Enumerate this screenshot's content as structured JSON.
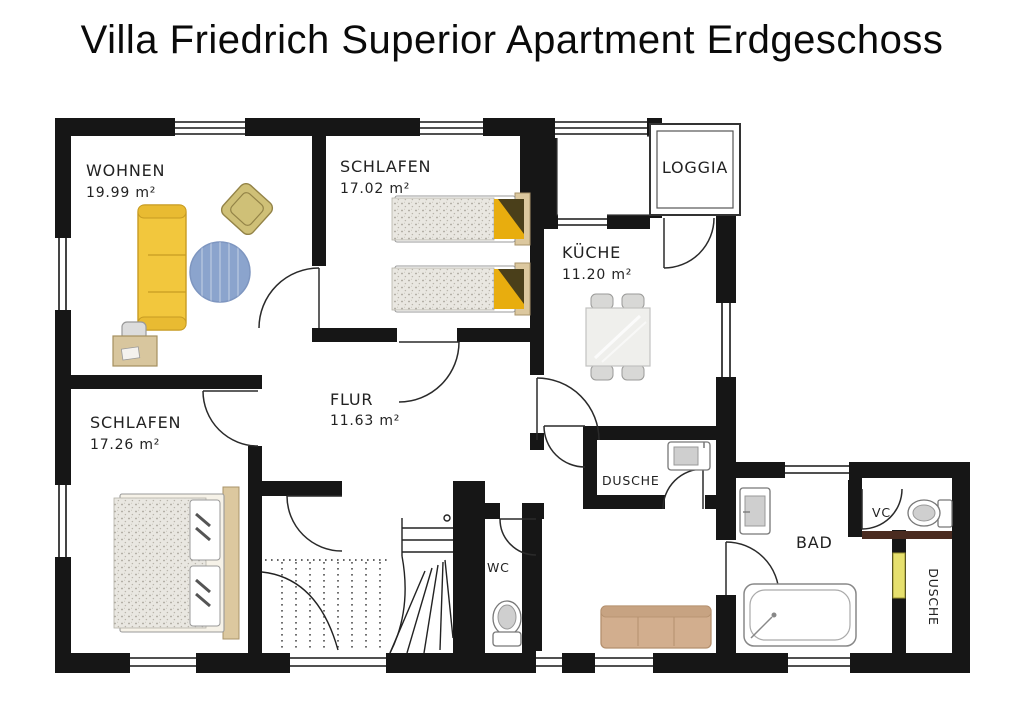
{
  "title": "Villa Friedrich Superior Apartment Erdgeschoss",
  "plan": {
    "rooms": {
      "wohnen": {
        "name": "WOHNEN",
        "area": "19.99 m²"
      },
      "schlafen_top": {
        "name": "SCHLAFEN",
        "area": "17.02 m²"
      },
      "kueche": {
        "name": "KÜCHE",
        "area": "11.20 m²"
      },
      "loggia": {
        "name": "LOGGIA"
      },
      "flur": {
        "name": "FLUR",
        "area": "11.63 m²"
      },
      "schlafen_bottom": {
        "name": "SCHLAFEN",
        "area": "17.26 m²"
      },
      "dusche_mid": {
        "name": "DUSCHE"
      },
      "wc": {
        "name": "WC"
      },
      "bad": {
        "name": "BAD"
      },
      "wc_small": {
        "name": "VC"
      },
      "dusche_right": {
        "name": "DUSCHE"
      }
    },
    "colors": {
      "wall": "#161616",
      "sofa": "#f2c73d",
      "sofa_edge": "#c79b22",
      "armchair": "#cfc077",
      "rug": "#8ba4cd",
      "couch": "#d2ae8e",
      "pillow_yellow": "#e8ad0e",
      "pillow_dark": "#4a3f1a",
      "headboard": "#dcc89f",
      "desk": "#d8c69e",
      "table": "#efefec",
      "door_panel_yellow": "#e6e06e",
      "vc_wall_accent": "#4a2b20"
    }
  }
}
